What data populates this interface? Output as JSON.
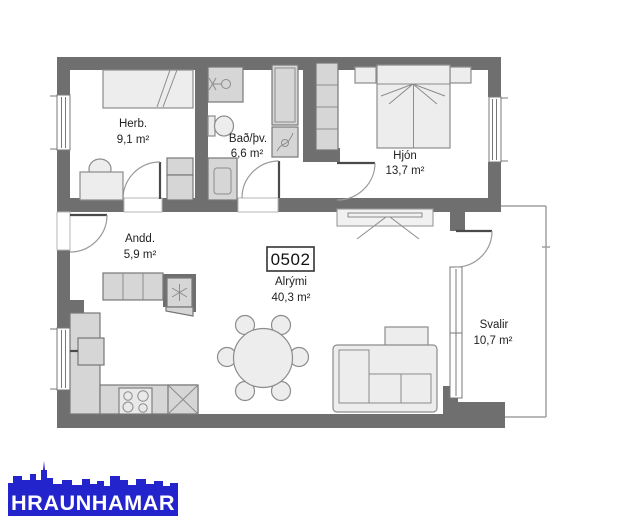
{
  "plan": {
    "unit_label": "0502",
    "rooms": [
      {
        "name": "Herb.",
        "area": "9,1 m²"
      },
      {
        "name": "Bað/þv.",
        "area": "6,6 m²"
      },
      {
        "name": "Hjón",
        "area": "13,7 m²"
      },
      {
        "name": "Andd.",
        "area": "5,9 m²"
      },
      {
        "name": "Alrými",
        "area": "40,3 m²"
      },
      {
        "name": "Svalir",
        "area": "10,7 m²"
      }
    ]
  },
  "logo": {
    "text": "HRAUNHAMAR",
    "color": "#2424cc"
  },
  "colors": {
    "wall": "#6f6f6f",
    "cabinet": "#d6d6d6",
    "furniture": "#ededed",
    "outline": "#8c8c8c",
    "label_text": "#222222"
  }
}
